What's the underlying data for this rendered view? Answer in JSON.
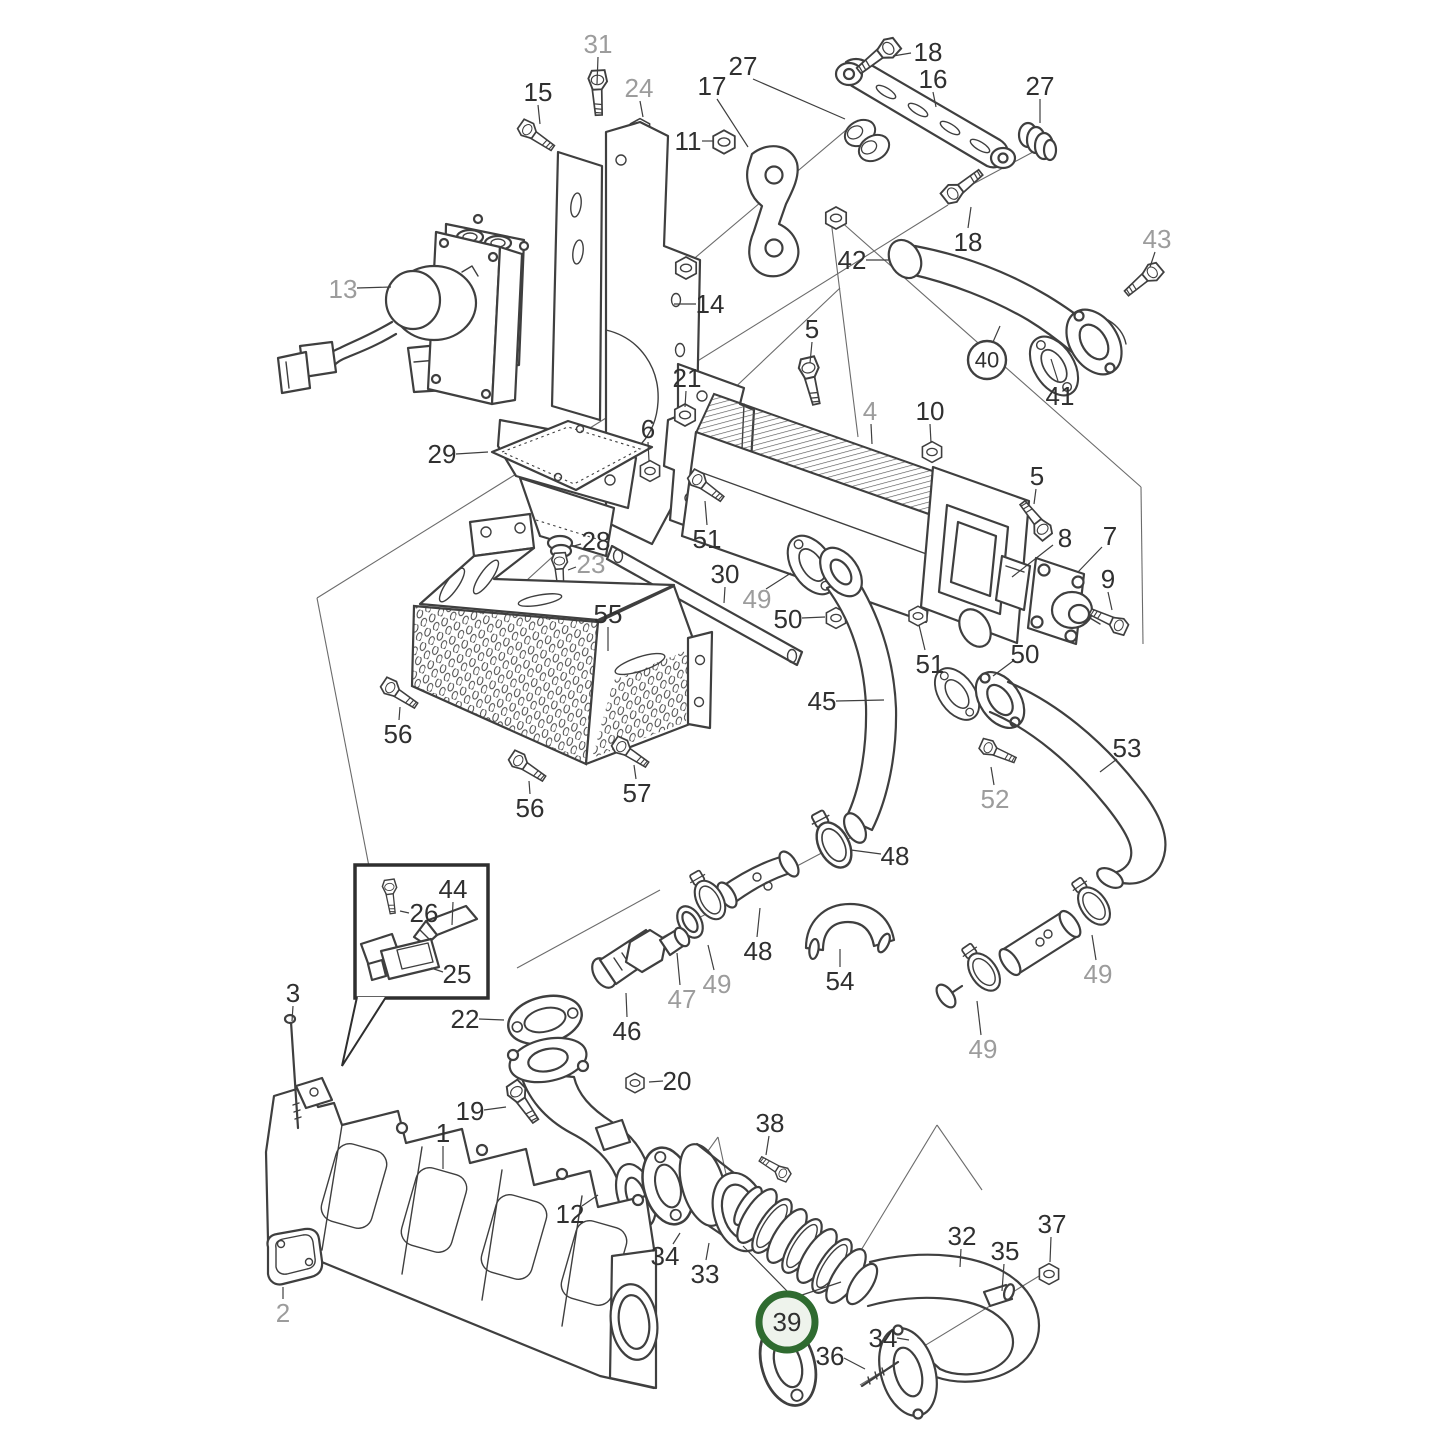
{
  "figure": {
    "width": 1445,
    "height": 1445,
    "background": "#ffffff",
    "line_color": "#3f3f3f",
    "leader_color": "#3f3f3f",
    "label_font_size": 26,
    "circled_font_size": 22
  },
  "styles": {
    "label_black": "#303030",
    "label_gray": "#9c9c9c",
    "green_ring": "#2f6b30",
    "green_fill": "#eef3ec",
    "plain_ring": "#3f3f3f",
    "plain_fill": "#ffffff"
  },
  "highlight": {
    "part": "39",
    "style": "green-circle"
  },
  "labels": [
    {
      "text": "31",
      "x": 598,
      "y": 44,
      "shade": "gray",
      "circle": "none",
      "leaders": [
        [
          598,
          57,
          597,
          84
        ]
      ]
    },
    {
      "text": "15",
      "x": 538,
      "y": 92,
      "shade": "black",
      "circle": "none",
      "leaders": [
        [
          538,
          105,
          540,
          124
        ]
      ]
    },
    {
      "text": "24",
      "x": 639,
      "y": 88,
      "shade": "gray",
      "circle": "none",
      "leaders": [
        [
          640,
          101,
          643,
          117
        ]
      ]
    },
    {
      "text": "17",
      "x": 712,
      "y": 86,
      "shade": "black",
      "circle": "none",
      "leaders": [
        [
          717,
          99,
          748,
          147
        ]
      ]
    },
    {
      "text": "27",
      "x": 743,
      "y": 66,
      "shade": "black",
      "circle": "none",
      "leaders": [
        [
          753,
          79,
          845,
          119
        ]
      ]
    },
    {
      "text": "18",
      "x": 928,
      "y": 52,
      "shade": "black",
      "circle": "none",
      "leaders": [
        [
          911,
          53,
          893,
          56
        ]
      ]
    },
    {
      "text": "16",
      "x": 933,
      "y": 79,
      "shade": "black",
      "circle": "none",
      "leaders": [
        [
          933,
          92,
          936,
          107
        ]
      ]
    },
    {
      "text": "27",
      "x": 1040,
      "y": 86,
      "shade": "black",
      "circle": "none",
      "leaders": [
        [
          1040,
          99,
          1040,
          123
        ]
      ]
    },
    {
      "text": "11",
      "x": 688,
      "y": 141,
      "shade": "black",
      "circle": "none",
      "leaders": [
        [
          702,
          141,
          713,
          141
        ]
      ]
    },
    {
      "text": "18",
      "x": 968,
      "y": 242,
      "shade": "black",
      "circle": "none",
      "leaders": [
        [
          968,
          228,
          971,
          207
        ]
      ]
    },
    {
      "text": "42",
      "x": 852,
      "y": 260,
      "shade": "black",
      "circle": "none",
      "leaders": [
        [
          866,
          260,
          890,
          260
        ]
      ]
    },
    {
      "text": "43",
      "x": 1157,
      "y": 239,
      "shade": "gray",
      "circle": "none",
      "leaders": [
        [
          1155,
          252,
          1150,
          267
        ]
      ]
    },
    {
      "text": "40",
      "x": 987,
      "y": 360,
      "shade": "black",
      "circle": "plain",
      "leaders": [
        [
          993,
          342,
          1000,
          326
        ]
      ]
    },
    {
      "text": "41",
      "x": 1060,
      "y": 396,
      "shade": "black",
      "circle": "none",
      "leaders": [
        [
          1058,
          381,
          1051,
          359
        ]
      ]
    },
    {
      "text": "13",
      "x": 343,
      "y": 289,
      "shade": "gray",
      "circle": "none",
      "leaders": [
        [
          357,
          288,
          391,
          287
        ]
      ]
    },
    {
      "text": "14",
      "x": 710,
      "y": 304,
      "shade": "black",
      "circle": "none",
      "leaders": [
        [
          696,
          304,
          674,
          304
        ]
      ]
    },
    {
      "text": "29",
      "x": 442,
      "y": 454,
      "shade": "black",
      "circle": "none",
      "leaders": [
        [
          456,
          454,
          488,
          452
        ]
      ]
    },
    {
      "text": "5",
      "x": 812,
      "y": 329,
      "shade": "black",
      "circle": "none",
      "leaders": [
        [
          812,
          342,
          810,
          363
        ]
      ]
    },
    {
      "text": "21",
      "x": 687,
      "y": 378,
      "shade": "black",
      "circle": "none",
      "leaders": [
        [
          686,
          391,
          685,
          407
        ]
      ]
    },
    {
      "text": "6",
      "x": 648,
      "y": 429,
      "shade": "black",
      "circle": "none",
      "leaders": [
        [
          648,
          442,
          649,
          461
        ]
      ]
    },
    {
      "text": "4",
      "x": 870,
      "y": 411,
      "shade": "gray",
      "circle": "none",
      "leaders": [
        [
          871,
          424,
          872,
          444
        ]
      ]
    },
    {
      "text": "10",
      "x": 930,
      "y": 411,
      "shade": "black",
      "circle": "none",
      "leaders": [
        [
          930,
          424,
          931,
          443
        ]
      ]
    },
    {
      "text": "5",
      "x": 1037,
      "y": 476,
      "shade": "black",
      "circle": "none",
      "leaders": [
        [
          1036,
          489,
          1034,
          504
        ]
      ]
    },
    {
      "text": "8",
      "x": 1065,
      "y": 538,
      "shade": "black",
      "circle": "none",
      "leaders": [
        [
          1053,
          545,
          1012,
          577
        ]
      ]
    },
    {
      "text": "7",
      "x": 1110,
      "y": 536,
      "shade": "black",
      "circle": "none",
      "leaders": [
        [
          1102,
          547,
          1078,
          572
        ]
      ]
    },
    {
      "text": "9",
      "x": 1108,
      "y": 579,
      "shade": "black",
      "circle": "none",
      "leaders": [
        [
          1108,
          592,
          1112,
          610
        ]
      ]
    },
    {
      "text": "51",
      "x": 707,
      "y": 539,
      "shade": "black",
      "circle": "none",
      "leaders": [
        [
          707,
          525,
          705,
          501
        ]
      ]
    },
    {
      "text": "28",
      "x": 596,
      "y": 541,
      "shade": "black",
      "circle": "none",
      "leaders": [
        [
          581,
          544,
          574,
          546
        ]
      ]
    },
    {
      "text": "23",
      "x": 591,
      "y": 564,
      "shade": "gray",
      "circle": "none",
      "leaders": [
        [
          576,
          567,
          568,
          570
        ]
      ]
    },
    {
      "text": "30",
      "x": 725,
      "y": 574,
      "shade": "black",
      "circle": "none",
      "leaders": [
        [
          725,
          587,
          724,
          603
        ]
      ]
    },
    {
      "text": "55",
      "x": 608,
      "y": 614,
      "shade": "black",
      "circle": "none",
      "leaders": [
        [
          608,
          627,
          608,
          651
        ]
      ]
    },
    {
      "text": "49",
      "x": 757,
      "y": 599,
      "shade": "gray",
      "circle": "none",
      "leaders": [
        [
          766,
          589,
          791,
          573
        ]
      ]
    },
    {
      "text": "50",
      "x": 788,
      "y": 619,
      "shade": "black",
      "circle": "none",
      "leaders": [
        [
          802,
          618,
          825,
          617
        ]
      ]
    },
    {
      "text": "51",
      "x": 930,
      "y": 664,
      "shade": "black",
      "circle": "none",
      "leaders": [
        [
          925,
          650,
          919,
          625
        ]
      ]
    },
    {
      "text": "50",
      "x": 1025,
      "y": 654,
      "shade": "black",
      "circle": "none",
      "leaders": [
        [
          1013,
          661,
          993,
          676
        ]
      ]
    },
    {
      "text": "45",
      "x": 822,
      "y": 701,
      "shade": "black",
      "circle": "none",
      "leaders": [
        [
          836,
          701,
          884,
          700
        ]
      ]
    },
    {
      "text": "53",
      "x": 1127,
      "y": 748,
      "shade": "black",
      "circle": "none",
      "leaders": [
        [
          1117,
          759,
          1100,
          772
        ]
      ]
    },
    {
      "text": "52",
      "x": 995,
      "y": 799,
      "shade": "gray",
      "circle": "none",
      "leaders": [
        [
          994,
          785,
          991,
          767
        ]
      ]
    },
    {
      "text": "56",
      "x": 398,
      "y": 734,
      "shade": "black",
      "circle": "none",
      "leaders": [
        [
          399,
          720,
          400,
          707
        ]
      ]
    },
    {
      "text": "56",
      "x": 530,
      "y": 808,
      "shade": "black",
      "circle": "none",
      "leaders": [
        [
          530,
          794,
          529,
          781
        ]
      ]
    },
    {
      "text": "57",
      "x": 637,
      "y": 793,
      "shade": "black",
      "circle": "none",
      "leaders": [
        [
          636,
          779,
          634,
          765
        ]
      ]
    },
    {
      "text": "48",
      "x": 895,
      "y": 856,
      "shade": "black",
      "circle": "none",
      "leaders": [
        [
          881,
          854,
          851,
          850
        ]
      ]
    },
    {
      "text": "48",
      "x": 758,
      "y": 951,
      "shade": "black",
      "circle": "none",
      "leaders": [
        [
          757,
          937,
          760,
          908
        ]
      ]
    },
    {
      "text": "54",
      "x": 840,
      "y": 981,
      "shade": "black",
      "circle": "none",
      "leaders": [
        [
          840,
          967,
          840,
          949
        ]
      ]
    },
    {
      "text": "49",
      "x": 717,
      "y": 984,
      "shade": "gray",
      "circle": "none",
      "leaders": [
        [
          714,
          970,
          708,
          945
        ]
      ]
    },
    {
      "text": "47",
      "x": 682,
      "y": 999,
      "shade": "gray",
      "circle": "none",
      "leaders": [
        [
          680,
          985,
          677,
          953
        ]
      ]
    },
    {
      "text": "46",
      "x": 627,
      "y": 1031,
      "shade": "black",
      "circle": "none",
      "leaders": [
        [
          627,
          1017,
          626,
          993
        ]
      ]
    },
    {
      "text": "49",
      "x": 1098,
      "y": 974,
      "shade": "gray",
      "circle": "none",
      "leaders": [
        [
          1096,
          960,
          1092,
          935
        ]
      ]
    },
    {
      "text": "49",
      "x": 983,
      "y": 1049,
      "shade": "gray",
      "circle": "none",
      "leaders": [
        [
          981,
          1035,
          977,
          1001
        ]
      ]
    },
    {
      "text": "44",
      "x": 453,
      "y": 889,
      "shade": "black",
      "circle": "none",
      "leaders": [
        [
          453,
          902,
          452,
          925
        ]
      ]
    },
    {
      "text": "26",
      "x": 424,
      "y": 913,
      "shade": "black",
      "circle": "none",
      "leaders": [
        [
          409,
          913,
          400,
          911
        ]
      ]
    },
    {
      "text": "25",
      "x": 457,
      "y": 974,
      "shade": "black",
      "circle": "none",
      "leaders": [
        [
          443,
          972,
          431,
          968
        ]
      ]
    },
    {
      "text": "22",
      "x": 465,
      "y": 1019,
      "shade": "black",
      "circle": "none",
      "leaders": [
        [
          479,
          1019,
          504,
          1020
        ]
      ]
    },
    {
      "text": "3",
      "x": 293,
      "y": 993,
      "shade": "black",
      "circle": "none",
      "leaders": [
        [
          293,
          1006,
          292,
          1021
        ]
      ]
    },
    {
      "text": "20",
      "x": 677,
      "y": 1081,
      "shade": "black",
      "circle": "none",
      "leaders": [
        [
          663,
          1081,
          649,
          1082
        ]
      ]
    },
    {
      "text": "19",
      "x": 470,
      "y": 1111,
      "shade": "black",
      "circle": "none",
      "leaders": [
        [
          484,
          1110,
          506,
          1107
        ]
      ]
    },
    {
      "text": "1",
      "x": 443,
      "y": 1133,
      "shade": "black",
      "circle": "none",
      "leaders": [
        [
          443,
          1146,
          443,
          1169
        ]
      ]
    },
    {
      "text": "12",
      "x": 570,
      "y": 1214,
      "shade": "black",
      "circle": "none",
      "leaders": [
        [
          582,
          1206,
          598,
          1195
        ]
      ]
    },
    {
      "text": "34",
      "x": 665,
      "y": 1256,
      "shade": "black",
      "circle": "none",
      "leaders": [
        [
          673,
          1244,
          680,
          1233
        ]
      ]
    },
    {
      "text": "33",
      "x": 705,
      "y": 1274,
      "shade": "black",
      "circle": "none",
      "leaders": [
        [
          706,
          1260,
          709,
          1243
        ]
      ]
    },
    {
      "text": "2",
      "x": 283,
      "y": 1313,
      "shade": "gray",
      "circle": "none",
      "leaders": [
        [
          283,
          1299,
          283,
          1287
        ]
      ]
    },
    {
      "text": "38",
      "x": 770,
      "y": 1123,
      "shade": "black",
      "circle": "none",
      "leaders": [
        [
          769,
          1136,
          766,
          1155
        ]
      ]
    },
    {
      "text": "39",
      "x": 787,
      "y": 1322,
      "shade": "black",
      "circle": "green",
      "leaders": [
        [
          787,
          1291,
          743,
          1246
        ],
        [
          796,
          1297,
          841,
          1282
        ]
      ]
    },
    {
      "text": "36",
      "x": 830,
      "y": 1356,
      "shade": "black",
      "circle": "none",
      "leaders": [
        [
          844,
          1358,
          865,
          1369
        ]
      ]
    },
    {
      "text": "34",
      "x": 883,
      "y": 1338,
      "shade": "black",
      "circle": "none",
      "leaders": [
        [
          897,
          1338,
          909,
          1340
        ]
      ]
    },
    {
      "text": "32",
      "x": 962,
      "y": 1236,
      "shade": "black",
      "circle": "none",
      "leaders": [
        [
          961,
          1249,
          960,
          1267
        ]
      ]
    },
    {
      "text": "35",
      "x": 1005,
      "y": 1251,
      "shade": "black",
      "circle": "none",
      "leaders": [
        [
          1004,
          1264,
          1002,
          1291
        ]
      ]
    },
    {
      "text": "37",
      "x": 1052,
      "y": 1224,
      "shade": "black",
      "circle": "none",
      "leaders": [
        [
          1051,
          1237,
          1050,
          1262
        ]
      ]
    }
  ]
}
